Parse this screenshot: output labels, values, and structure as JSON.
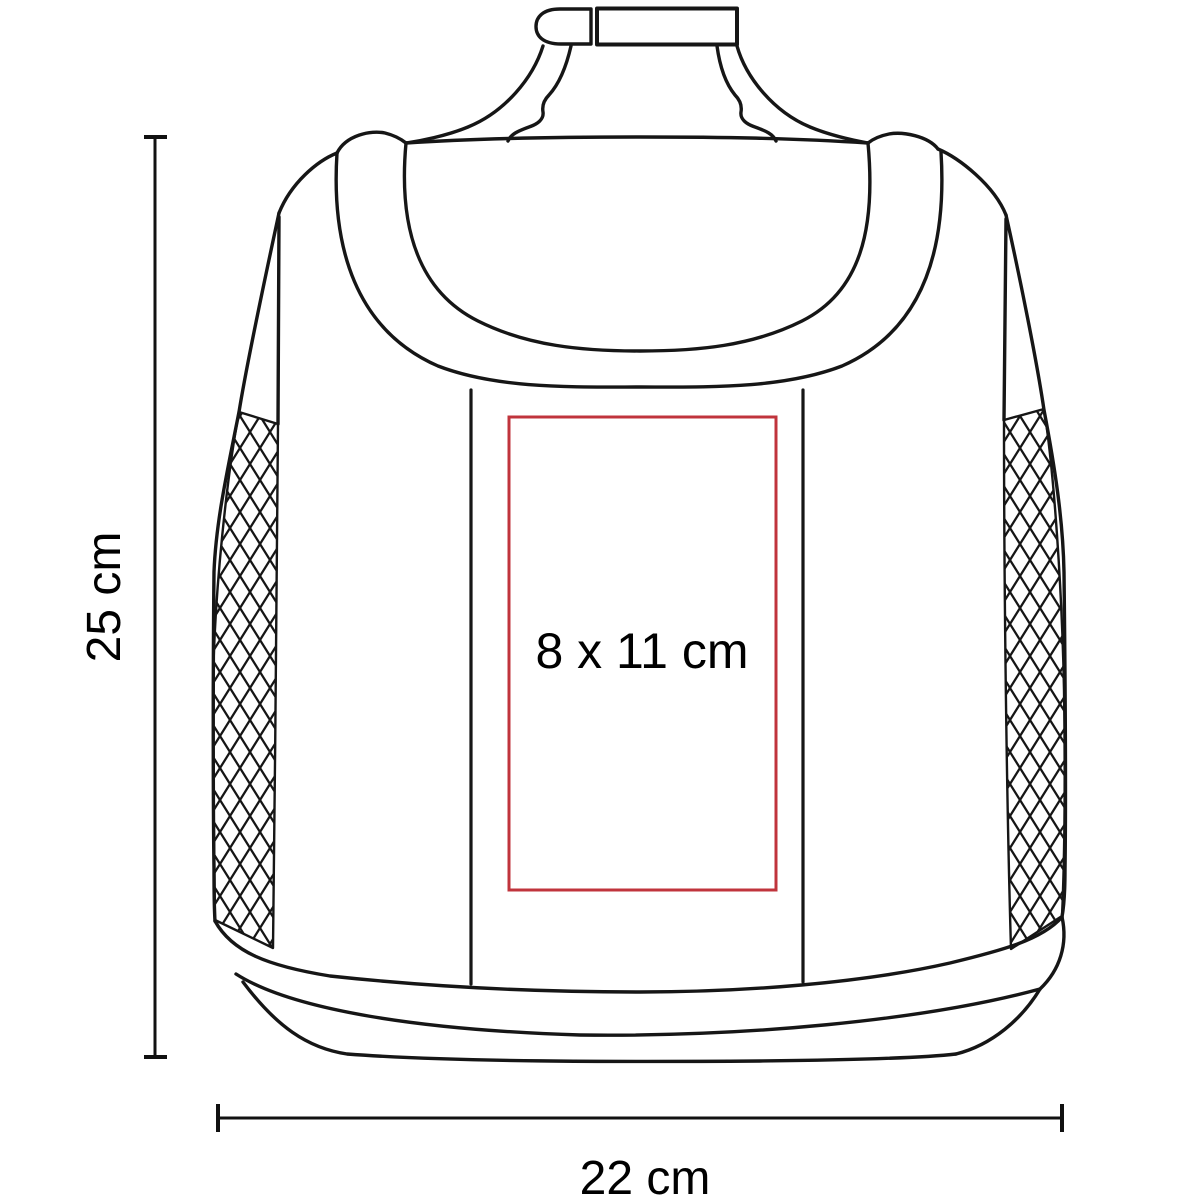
{
  "diagram": {
    "labels": {
      "height": "25 cm",
      "width": "22 cm",
      "print_area": "8 x 11 cm"
    },
    "colors": {
      "outline": "#161616",
      "dimension_line": "#111111",
      "print_area_border": "#c0343c",
      "background": "#ffffff",
      "text": "#000000"
    }
  }
}
